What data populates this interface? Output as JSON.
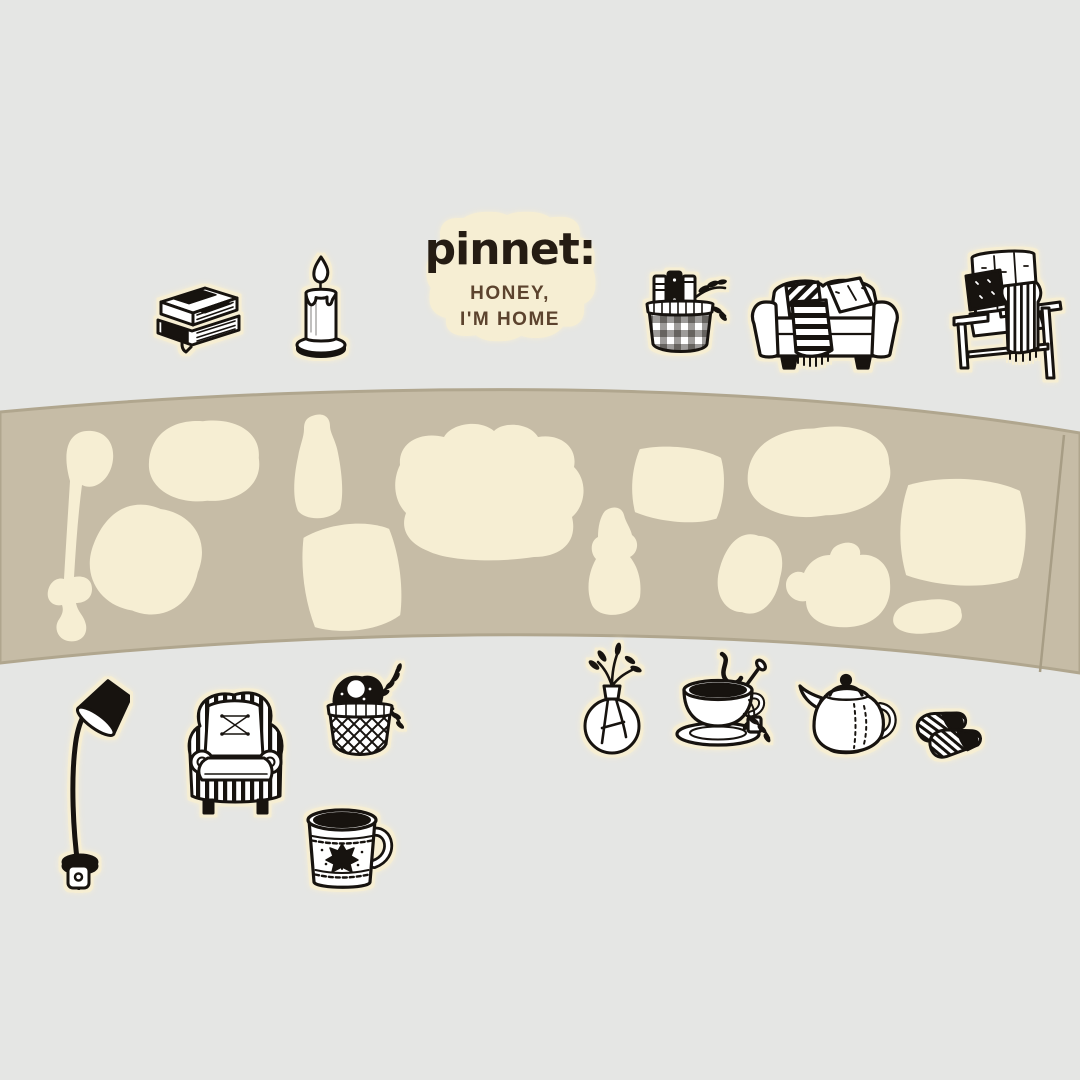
{
  "colors": {
    "background": "#e5e6e4",
    "strip": "#c6bca6",
    "strip_edge": "#b0a68e",
    "die_cut": "#f6eed3",
    "ink": "#17130f",
    "brand_text": "#251c13",
    "tagline_text": "#5c432e",
    "halo": "#f6eed3"
  },
  "logo": {
    "brand": "pinnet",
    "colon": ":",
    "tagline_line1": "HONEY,",
    "tagline_line2": "I'M HOME"
  },
  "stickers": {
    "top_row": [
      "stacked-books",
      "lit-candle",
      "brand-label",
      "book-basket",
      "sofa-with-throw",
      "wooden-armchair"
    ],
    "bottom_row": [
      "floor-lamp",
      "wingback-armchair",
      "plant-basket",
      "coffee-mug",
      "bud-vase",
      "teacup",
      "teapot",
      "slippers"
    ]
  },
  "backing_strip": {
    "die_cut_count": 13
  }
}
